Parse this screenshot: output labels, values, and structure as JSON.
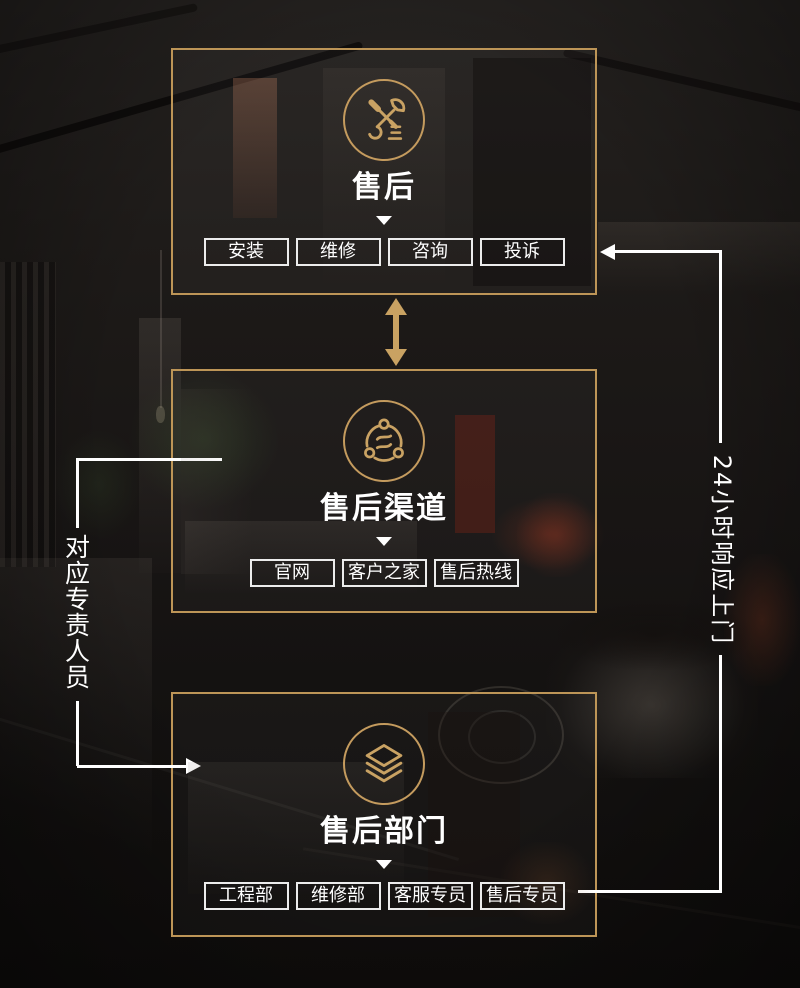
{
  "colors": {
    "accent_gold": "#C49B5E",
    "frame_gold": "#BD9557",
    "line_white": "#FFFFFF"
  },
  "sections": [
    {
      "title": "售后",
      "icon": "repair-tools-icon",
      "buttons": [
        "安装",
        "维修",
        "咨询",
        "投诉"
      ]
    },
    {
      "title": "售后渠道",
      "icon": "channels-icon",
      "buttons": [
        "官网",
        "客户之家",
        "售后热线"
      ]
    },
    {
      "title": "售后部门",
      "icon": "layers-icon",
      "buttons": [
        "工程部",
        "维修部",
        "客服专员",
        "售后专员"
      ]
    }
  ],
  "annotations": {
    "left_vertical_label": "对应专责人员",
    "right_vertical_label": "24小时响应上门"
  }
}
